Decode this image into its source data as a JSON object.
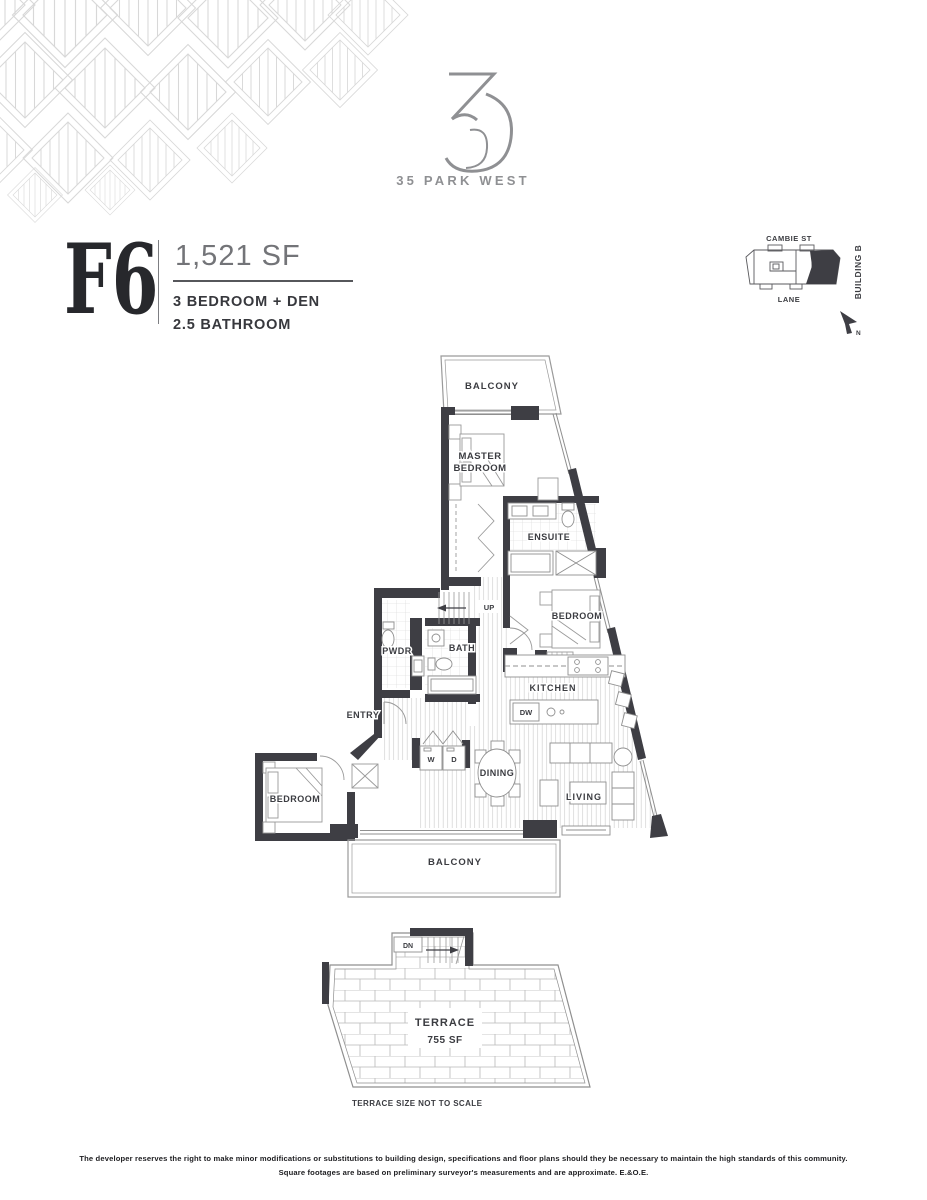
{
  "brand": {
    "mark": "35",
    "name": "35 PARK WEST"
  },
  "unit": {
    "code": "F6",
    "area": "1,521 SF",
    "spec_line1": "3 BEDROOM + DEN",
    "spec_line2": "2.5 BATHROOM"
  },
  "site_plan": {
    "street_top": "CAMBIE ST",
    "street_bottom": "LANE",
    "building_label": "BUILDING B",
    "north_label": "N"
  },
  "floor_plan": {
    "balcony_top": "BALCONY",
    "master_line1": "MASTER",
    "master_line2": "BEDROOM",
    "ensuite": "ENSUITE",
    "bedroom_right": "BEDROOM",
    "stairs_up": "UP",
    "bath": "BATH",
    "powder": "PWDR",
    "entry": "ENTRY",
    "kitchen": "KITCHEN",
    "dishwasher": "DW",
    "washer": "W",
    "dryer": "D",
    "dining": "DINING",
    "living": "LIVING",
    "bedroom_left": "BEDROOM",
    "balcony_bottom": "BALCONY"
  },
  "terrace_plan": {
    "label": "TERRACE",
    "area": "755 SF",
    "stairs_down": "DN",
    "note": "TERRACE SIZE NOT TO SCALE"
  },
  "footer": {
    "line1": "The developer reserves the right to make minor modifications or substitutions to building design, specifications and floor plans should they be necessary to maintain the high standards of this community.",
    "line2": "Square footages are based on preliminary surveyor's measurements and are approximate. E.&O.E."
  },
  "colors": {
    "wall": "#3e3e44",
    "label_text": "#3b3c41",
    "brand_gray": "#8f9093",
    "area_gray": "#737478",
    "thin_line": "#8f8f8f",
    "hatch_line": "#d2d2d2",
    "deco_line": "#d8d8d8"
  }
}
